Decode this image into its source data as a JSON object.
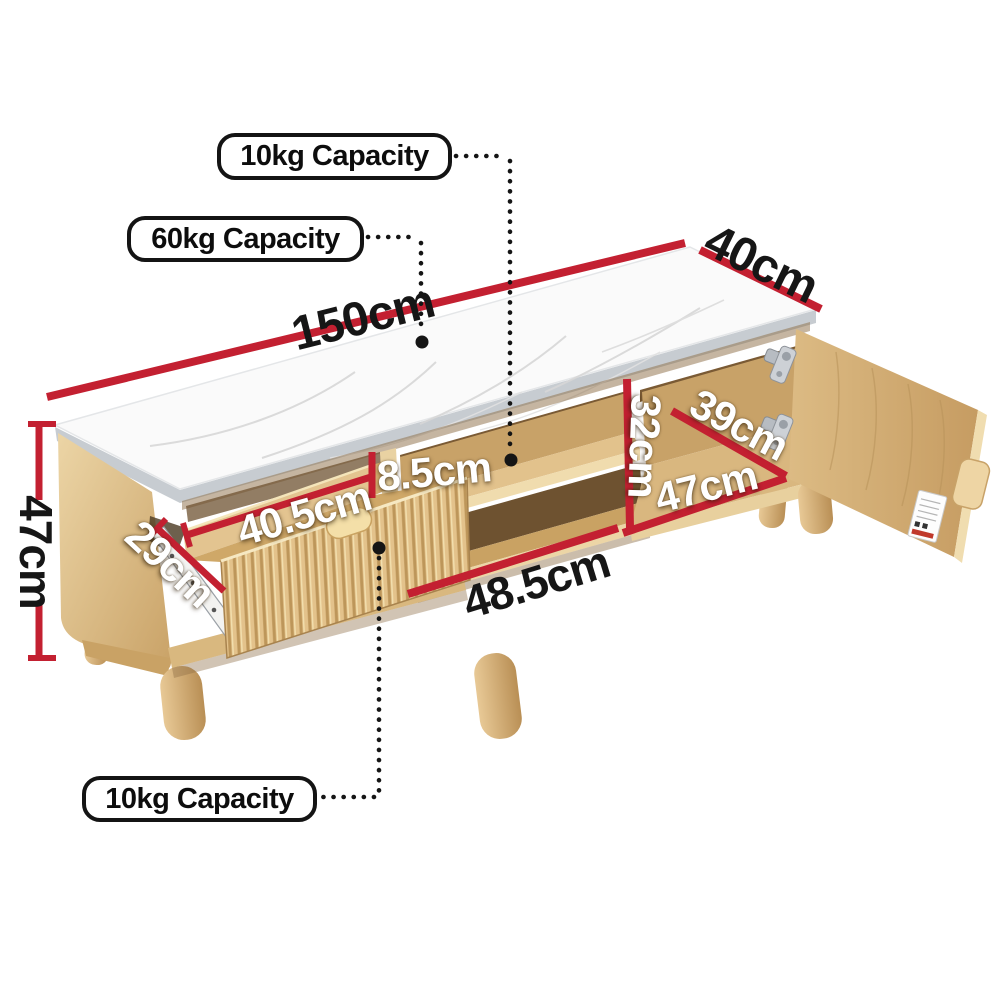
{
  "diagram": {
    "product": "TV entertainment unit with marble-look top, fluted drawer, open shelves and cabinet door",
    "callouts": {
      "shelf": {
        "label": "10kg Capacity"
      },
      "top": {
        "label": "60kg Capacity"
      },
      "drawer": {
        "label": "10kg Capacity"
      }
    },
    "dimensions": {
      "overall_length": {
        "label": "150cm"
      },
      "overall_depth": {
        "label": "40cm"
      },
      "overall_height": {
        "label": "47cm"
      },
      "drawer_depth": {
        "label": "29cm"
      },
      "drawer_width": {
        "label": "40.5cm"
      },
      "top_gap": {
        "label": "8.5cm"
      },
      "middle_width": {
        "label": "48.5cm"
      },
      "cabinet_height": {
        "label": "32cm"
      },
      "cabinet_depth": {
        "label": "39cm"
      },
      "cabinet_width": {
        "label": "47cm"
      }
    },
    "colors": {
      "dimension_red": "#c32031",
      "connector_black": "#151515",
      "callout_border": "#141414",
      "wood_light": "#e9d0a0",
      "wood_mid": "#d9b87f",
      "wood_dark": "#b08a50",
      "marble_white": "#fafafa"
    }
  }
}
